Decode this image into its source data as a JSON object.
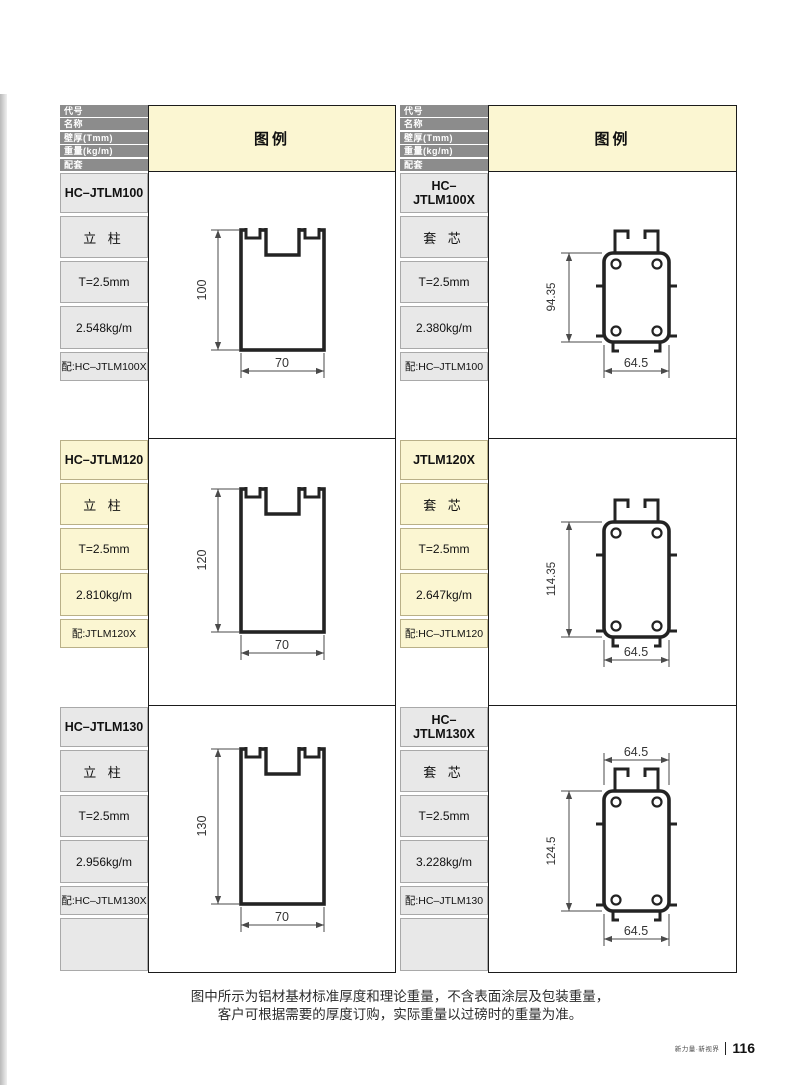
{
  "header": {
    "rows": [
      "代号",
      "名称",
      "壁厚(Tmm)",
      "重量(kg/m)",
      "配套"
    ],
    "legend_label": "图例"
  },
  "entries": [
    {
      "code": "HC–JTLM100",
      "name": "立 柱",
      "thickness": "T=2.5mm",
      "weight": "2.548kg/m",
      "match": "配:HC–JTLM100X",
      "dims": {
        "height": "100",
        "width": "70"
      }
    },
    {
      "code": "HC–JTLM100X",
      "name": "套 芯",
      "thickness": "T=2.5mm",
      "weight": "2.380kg/m",
      "match": "配:HC–JTLM100",
      "dims": {
        "height": "94.35",
        "width": "64.5"
      }
    },
    {
      "code": "HC–JTLM120",
      "name": "立 柱",
      "thickness": "T=2.5mm",
      "weight": "2.810kg/m",
      "match": "配:JTLM120X",
      "dims": {
        "height": "120",
        "width": "70"
      }
    },
    {
      "code": "JTLM120X",
      "name": "套 芯",
      "thickness": "T=2.5mm",
      "weight": "2.647kg/m",
      "match": "配:HC–JTLM120",
      "dims": {
        "height": "114.35",
        "width": "64.5"
      }
    },
    {
      "code": "HC–JTLM130",
      "name": "立 柱",
      "thickness": "T=2.5mm",
      "weight": "2.956kg/m",
      "match": "配:HC–JTLM130X",
      "dims": {
        "height": "130",
        "width": "70"
      }
    },
    {
      "code": "HC–JTLM130X",
      "name": "套 芯",
      "thickness": "T=2.5mm",
      "weight": "3.228kg/m",
      "match": "配:HC–JTLM130",
      "dims": {
        "height": "124.5",
        "width_top": "64.5",
        "width_bottom": "64.5"
      }
    }
  ],
  "note": {
    "line1": "图中所示为铝材基材标准厚度和理论重量，不含表面涂层及包装重量，",
    "line2": "客户可根据需要的厚度订购，实际重量以过磅时的重量为准。"
  },
  "footer": {
    "brand": "新力量·新视界",
    "page_number": "116"
  },
  "colors": {
    "header_gray": "#8c8c8c",
    "cell_gray": "#e8e8e8",
    "highlight_yellow": "#fbf6d2",
    "table_border": "#1b1b1b",
    "drawing_ink": "#232323"
  }
}
